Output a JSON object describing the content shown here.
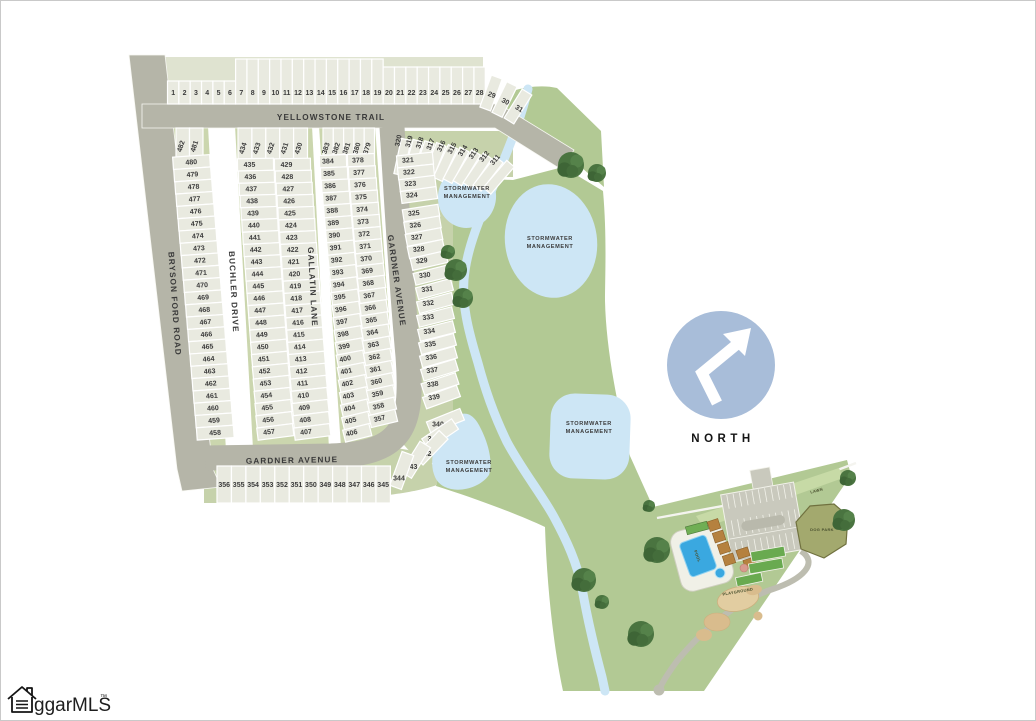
{
  "map": {
    "north": {
      "label": "NORTH"
    },
    "watermark": {
      "text": "ggarMLS",
      "tm": "™"
    },
    "streets": [
      {
        "name": "YELLOWSTONE TRAIL"
      },
      {
        "name": "BRYSON FORD ROAD"
      },
      {
        "name": "BUCHLER DRIVE"
      },
      {
        "name": "GALLATIN LANE"
      },
      {
        "name": "GARDNER AVENUE"
      },
      {
        "name": "GARDNER AVENUE"
      }
    ],
    "stormwater": [
      {
        "line1": "STORMWATER",
        "line2": "MANAGEMENT"
      },
      {
        "line1": "STORMWATER",
        "line2": "MANAGEMENT"
      },
      {
        "line1": "STORMWATER",
        "line2": "MANAGEMENT"
      },
      {
        "line1": "STORMWATER",
        "line2": "MANAGEMENT"
      }
    ],
    "amenities": {
      "lawn": "LAWN",
      "dog_park": "DOG PARK",
      "playground": "PLAYGROUND",
      "pool": "POOL"
    },
    "lots": {
      "yellowstone_row": [
        "1",
        "2",
        "3",
        "4",
        "5",
        "6",
        "7",
        "8",
        "9",
        "10",
        "11",
        "12",
        "13",
        "14",
        "15",
        "16",
        "17",
        "18",
        "19",
        "20",
        "21",
        "22",
        "23",
        "24",
        "25",
        "26",
        "27",
        "28"
      ],
      "yellowstone_row_end": [
        "29",
        "30",
        "31"
      ],
      "bryson_top": [
        "482",
        "481"
      ],
      "bryson_column": [
        "480",
        "479",
        "478",
        "477",
        "476",
        "475",
        "474",
        "473",
        "472",
        "471",
        "470",
        "469",
        "468",
        "467",
        "466",
        "465",
        "464",
        "463",
        "462",
        "461",
        "460",
        "459",
        "458"
      ],
      "buchler_top": [
        "434",
        "433",
        "432",
        "431",
        "430"
      ],
      "buchler_west": [
        "435",
        "436",
        "437",
        "438",
        "439",
        "440",
        "441",
        "442",
        "443",
        "444",
        "445",
        "446",
        "447",
        "448",
        "449",
        "450",
        "451",
        "452",
        "453",
        "454",
        "455",
        "456",
        "457"
      ],
      "buchler_east": [
        "429",
        "428",
        "427",
        "426",
        "425",
        "424",
        "423",
        "422",
        "421",
        "420",
        "419",
        "418",
        "417",
        "416",
        "415",
        "414",
        "413",
        "412",
        "411",
        "410",
        "409",
        "408",
        "407"
      ],
      "gallatin_top": [
        "383",
        "382",
        "381",
        "380",
        "379"
      ],
      "gallatin_west": [
        "384",
        "385",
        "386",
        "387",
        "388",
        "389",
        "390",
        "391",
        "392",
        "393",
        "394",
        "395",
        "396",
        "397",
        "398",
        "399",
        "400",
        "401",
        "402",
        "403",
        "404",
        "405",
        "406"
      ],
      "gallatin_east": [
        "378",
        "377",
        "376",
        "375",
        "374",
        "373",
        "372",
        "371",
        "370",
        "369",
        "368",
        "367",
        "366",
        "365",
        "364",
        "363",
        "362",
        "361",
        "360",
        "359",
        "358",
        "357"
      ],
      "gardner_fan": [
        "320",
        "319",
        "318",
        "317",
        "316",
        "315",
        "314",
        "313",
        "312",
        "311"
      ],
      "gardner_column": [
        "321",
        "322",
        "323",
        "324",
        "325",
        "326",
        "327",
        "328",
        "329",
        "330",
        "331",
        "332",
        "333",
        "334",
        "335",
        "336",
        "337",
        "338",
        "339"
      ],
      "gardner_curve": [
        "340",
        "341",
        "342",
        "343",
        "344"
      ],
      "gardner_bottom_row": [
        "356",
        "355",
        "354",
        "353",
        "352",
        "351",
        "350",
        "349",
        "348",
        "347",
        "346",
        "345"
      ]
    }
  }
}
